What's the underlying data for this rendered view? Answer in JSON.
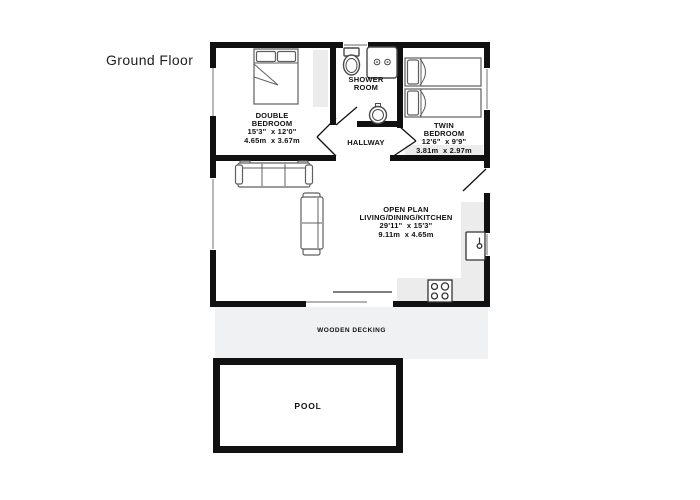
{
  "page": {
    "heading": "Ground Floor"
  },
  "plan": {
    "rooms": {
      "double_bedroom": {
        "line1": "DOUBLE",
        "line2": "BEDROOM",
        "imperial": "15'3\"  x 12'0\"",
        "metric": "4.65m  x 3.67m"
      },
      "shower_room": {
        "line1": "SHOWER",
        "line2": "ROOM"
      },
      "twin_bedroom": {
        "line1": "TWIN",
        "line2": "BEDROOM",
        "imperial": "12'6\"  x 9'9\"",
        "metric": "3.81m  x 2.97m"
      },
      "hallway": {
        "name": "HALLWAY"
      },
      "open_plan": {
        "line1": "OPEN PLAN",
        "line2": "LIVING/DINING/KITCHEN",
        "imperial": "29'11\"  x 15'3\"",
        "metric": "9.11m  x 4.65m"
      }
    },
    "outdoor": {
      "decking": "WOODEN DECKING",
      "pool": "POOL"
    },
    "icons": [
      "double-bed-icon",
      "twin-bed-icon",
      "twin-bed-icon",
      "sofa-3-seat-icon",
      "sofa-2-seat-icon",
      "toilet-icon",
      "shower-icon",
      "basin-icon",
      "kitchen-sink-icon",
      "hob-icon"
    ]
  },
  "theme": {
    "wall": "#111111",
    "counter": "#ececec",
    "decking": "#f0f1f2",
    "furniture_line": "#5f5f5f",
    "window_line": "#9a9a9a",
    "text": "#111111"
  }
}
